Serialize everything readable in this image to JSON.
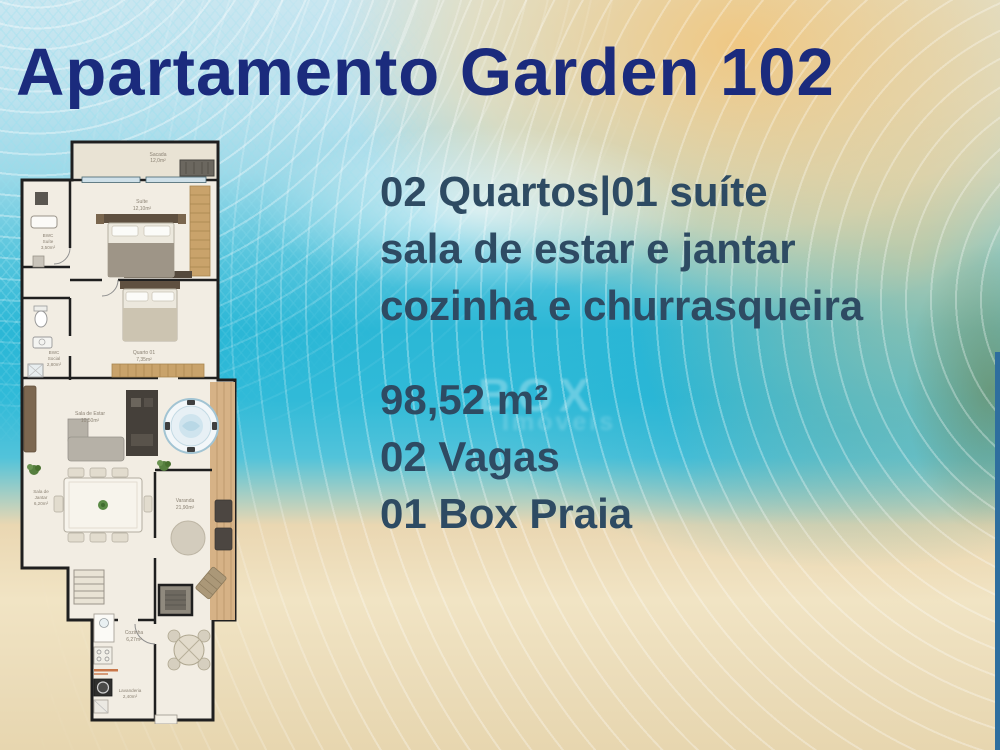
{
  "title": "Apartamento Garden 102",
  "colors": {
    "title_text": "#1b2b7d",
    "body_text": "#2e4b63",
    "water": "#2bb7d6",
    "sand": "#ebdcb9",
    "plan_wall": "#1f1f1f"
  },
  "features": {
    "lines": [
      "02 Quartos|01 suíte",
      "sala de estar e jantar",
      "cozinha e churrasqueira"
    ]
  },
  "specs": {
    "lines": [
      "98,52 m²",
      "02 Vagas",
      "01 Box Praia"
    ]
  },
  "watermark": {
    "line1": "BOX",
    "line2": "Imóveis"
  },
  "floorplan": {
    "rooms": {
      "sacada": {
        "line1": "Sacada",
        "line2": "12,0m²"
      },
      "suite": {
        "line1": "Suíte",
        "line2": "12,10m²"
      },
      "bwc_suite": {
        "line1": "BWC",
        "line2": "Suíte",
        "line3": "3,50m²"
      },
      "bwc_social": {
        "line1": "BWC",
        "line2": "Social",
        "line3": "2,80m²"
      },
      "quarto": {
        "line1": "Quarto 01",
        "line2": "7,35m²"
      },
      "sala_estar": {
        "line1": "Sala de Estar",
        "line2": "10,50m²"
      },
      "sala_jantar": {
        "line1": "Sala de",
        "line2": "Jantar",
        "line3": "6,20m²"
      },
      "varanda": {
        "line1": "Varanda",
        "line2": "21,90m²"
      },
      "cozinha": {
        "line1": "Cozinha",
        "line2": "6,27m²"
      },
      "lavanderia": {
        "line1": "Lavanderia",
        "line2": "2,40m²"
      }
    }
  }
}
